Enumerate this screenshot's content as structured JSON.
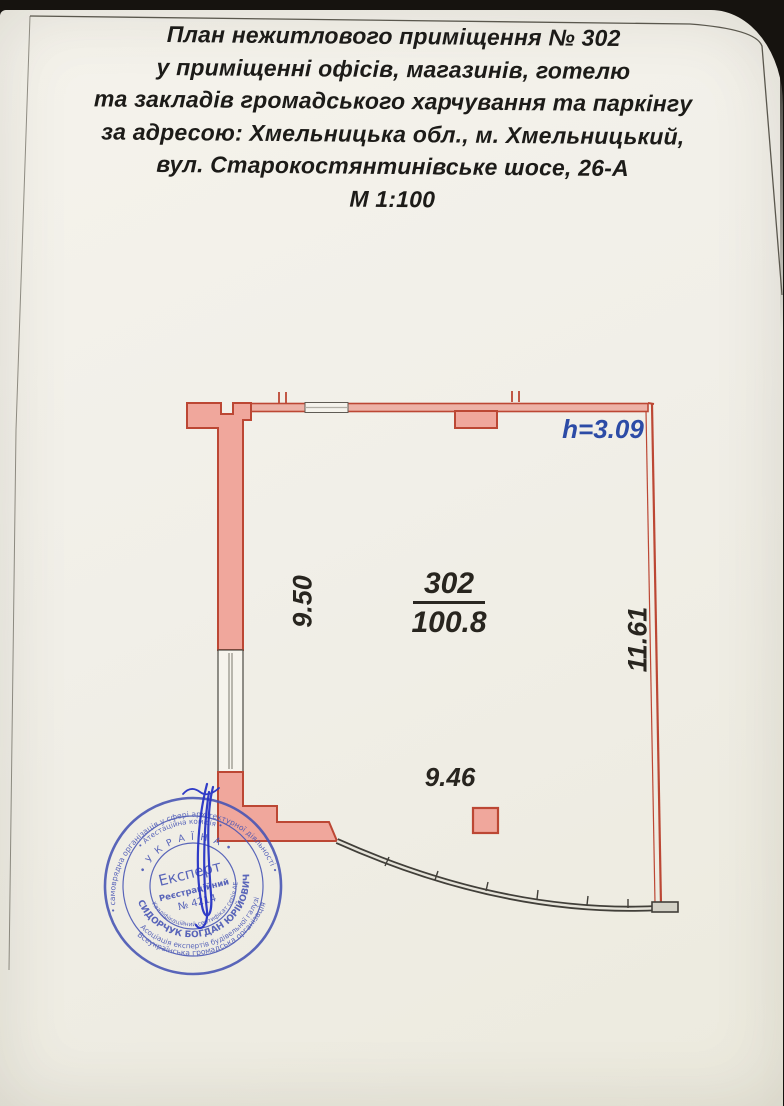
{
  "document": {
    "title_lines": [
      "План нежитлового приміщення № 302",
      "у приміщенні офісів, магазинів, готелю",
      "та закладів громадського харчування та паркінгу",
      "за адресою: Хмельницька обл., м. Хмельницький,",
      "вул. Старокостянтинівське шосе, 26-А",
      "М 1:100"
    ]
  },
  "plan": {
    "height_label": "h=3.09",
    "room": {
      "number": "302",
      "area": "100.8"
    },
    "dimensions": {
      "left": "9.50",
      "right": "11.61",
      "bottom": "9.46"
    },
    "colors": {
      "wall_fill": "#f0a79c",
      "wall_stroke": "#bc4734",
      "dim_blue": "#2c4ba6",
      "stamp_ink": "#4553b4",
      "signature_ink": "#2633c6"
    }
  },
  "stamp": {
    "ring_outer_top": "• самоврядна організація у сфері архітектурної діяльності •",
    "ring_outer_bottom": "Всеукраїнська громадська організація",
    "ring_mid_top": "• Атестаційна комісія •",
    "ring_mid_bottom": "Асоціація експертів будівельної галузі",
    "arc_country": "• У К Р А Ї Н А •",
    "ring_name": "СИДОРЧУК БОГДАН ЮРІЙОВИЧ",
    "ring_cert": "Кваліфікаційний сертифікат серія АЕ",
    "center_title": "Експерт",
    "center_reg_label": "Реєстраційний",
    "center_reg_number": "№ 4214"
  }
}
